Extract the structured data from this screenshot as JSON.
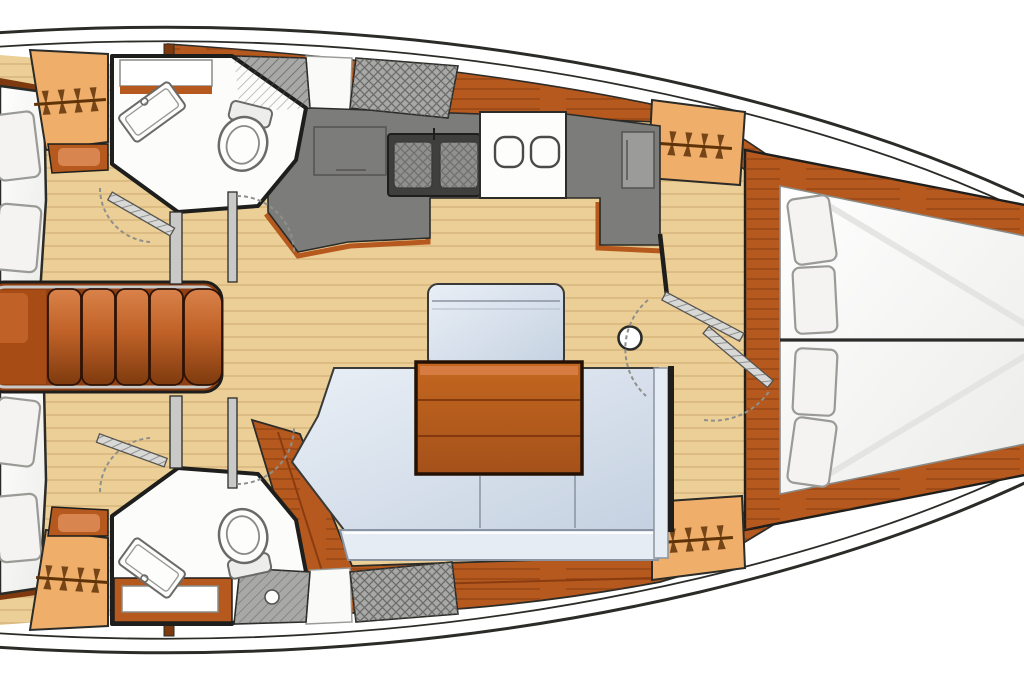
{
  "diagram": {
    "type": "sailboat-interior-floor-plan",
    "orientation": "bow-right-stern-left",
    "colors": {
      "hull_fill": "#ffffff",
      "hull_outline": "#2b2b28",
      "floor": "#eccf96",
      "floor_line": "#c8a468",
      "deck_wood": "#b5591f",
      "deck_wood_dark": "#8a3c10",
      "deck_wood_light": "#d9824a",
      "locker": "#efae6a",
      "hanger": "#5f3308",
      "counter": "#7c7c7a",
      "counter_light": "#9b9b99",
      "stove_dark": "#3f3f3d",
      "burner": "#90908e",
      "hatch_panel": "#a8a8a6",
      "hatch_line": "#6a6a68",
      "cushion": "#cfdae8",
      "cushion_light": "#e6ecf4",
      "table_wood": "#b45a1c",
      "step_light": "#d9824a",
      "step_dark": "#7e3a0e",
      "berth_white": "#ffffff",
      "pillow": "#f4f3f1",
      "pillow_edge": "#9a9a96",
      "wall": "#1e1e1c",
      "door_arc": "#8f8f8b",
      "fixture_white": "#fdfdfc",
      "fixture_edge": "#6a6a68",
      "rail_silver": "#c9c9c7"
    },
    "counts": {
      "companionway_steps": 5,
      "stove_burners": 2,
      "galley_sinks": 2,
      "toilets": 2,
      "bathroom_sinks": 2,
      "hanging_lockers": 4,
      "vberth_pillows": 4,
      "aft_berth_pillows_visible": 4,
      "interior_doors_shown": 6,
      "mast_count": 1
    },
    "regions": [
      {
        "name": "aft-cabin-top",
        "features": [
          "double-berth",
          "pillows",
          "hanging-locker",
          "shelf"
        ]
      },
      {
        "name": "head-top",
        "features": [
          "wash-basin",
          "toilet",
          "shower-grate",
          "shelf"
        ]
      },
      {
        "name": "galley",
        "features": [
          "two-burner-stove",
          "double-sink",
          "fridge",
          "counter",
          "nav-desk"
        ]
      },
      {
        "name": "companionway",
        "features": [
          "five-steps",
          "handrails",
          "cabin-doors"
        ]
      },
      {
        "name": "salon",
        "features": [
          "l-shaped-settee",
          "wood-table",
          "fore-bench",
          "mast-foot"
        ]
      },
      {
        "name": "head-bottom",
        "features": [
          "wash-basin",
          "toilet",
          "shower-grate",
          "shelf"
        ]
      },
      {
        "name": "aft-cabin-bottom",
        "features": [
          "double-berth",
          "pillows",
          "hanging-locker",
          "shelf"
        ]
      },
      {
        "name": "forward-cabin",
        "features": [
          "v-berth",
          "four-pillows",
          "two-hanging-lockers",
          "cabinet",
          "doors"
        ]
      }
    ],
    "icons": [
      "hanger-icon",
      "toilet-icon",
      "basin-icon",
      "stove-burner-icon",
      "galley-sink-icon",
      "mast-icon",
      "door-arc-icon",
      "door-leaf-icon",
      "steps-icon",
      "deck-hatch-icon"
    ]
  }
}
